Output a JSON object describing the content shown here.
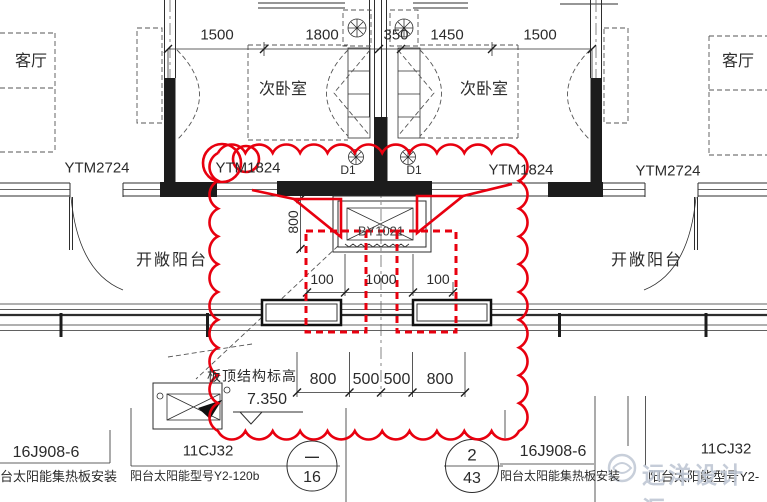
{
  "drawing": {
    "rooms": {
      "living_left": "客厅",
      "living_right": "客厅",
      "bedroom_left": "次卧室",
      "bedroom_right": "次卧室",
      "balcony_left": "开敞阳台",
      "balcony_right": "开敞阳台"
    },
    "windows": {
      "outer_left": "YTM2724",
      "inner_left": "YTM1824",
      "inner_right": "YTM1824",
      "outer_right": "YTM2724"
    },
    "doors": {
      "left": "D1",
      "right": "D1"
    },
    "collector_box_label": "BY1021",
    "dims": {
      "top": [
        "1500",
        "1800",
        "350",
        "1450",
        "1500"
      ],
      "mid": [
        "100",
        "1000",
        "100"
      ],
      "bottom": [
        "800",
        "500",
        "500",
        "800"
      ],
      "vertical": "800"
    },
    "elevation": {
      "label": "板顶结构标高",
      "value": "7.350"
    }
  },
  "legend": {
    "left": {
      "atlas_a": "16J908-6",
      "desc_a": "阳台太阳能集热板安装",
      "atlas_b": "11CJ32",
      "desc_b": "阳台太阳能型号Y2-120b",
      "bubble_top": "—",
      "bubble_bottom": "16"
    },
    "right": {
      "bubble_top": "2",
      "bubble_bottom": "43",
      "atlas_a": "16J908-6",
      "desc_a": "阳台太阳能集热板安装",
      "atlas_b": "11CJ32",
      "desc_b": "阳台太阳能型号Y2-"
    }
  },
  "watermark": {
    "text": "远洋设计汇"
  },
  "colors": {
    "revision_red": "#e8000f",
    "line_dark": "#2e2e2e",
    "watermark_gray": "#bfc7d4"
  }
}
